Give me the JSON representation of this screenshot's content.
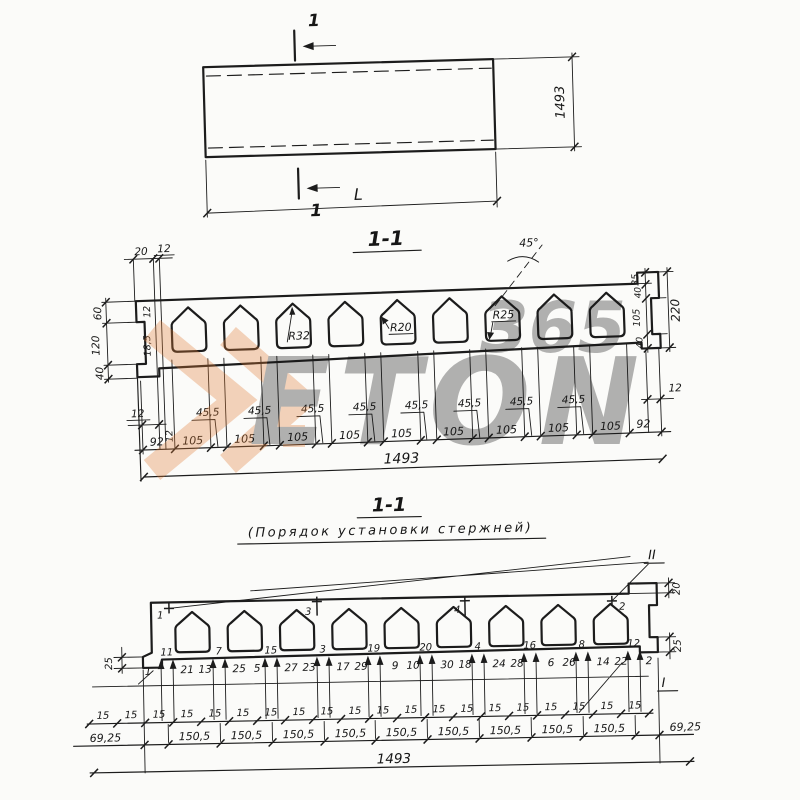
{
  "watermark": {
    "word": "ETON",
    "number": "365",
    "orange": "#e07c35",
    "gray": "#a9a9a9"
  },
  "plan": {
    "cut_label": "1",
    "width": "1493",
    "length": "L"
  },
  "section": {
    "title": "1-1",
    "angle": "45°",
    "radius_labels": [
      "R32",
      "R20",
      "R25"
    ],
    "top_left_dims": [
      "20",
      "12"
    ],
    "left_chain": [
      "60",
      "120",
      "40"
    ],
    "bar_dims": [
      "12",
      "18,5",
      "12"
    ],
    "left_offset": "12",
    "right_offset": "12",
    "edge_left": "92",
    "edge_right": "92",
    "void_dims": [
      "105",
      "105",
      "105",
      "105",
      "105",
      "105",
      "105",
      "105",
      "105"
    ],
    "web_dims": [
      "45,5",
      "45,5",
      "45,5",
      "45,5",
      "45,5",
      "45,5",
      "45,5",
      "45,5"
    ],
    "right_chain": [
      "35",
      "40",
      "105",
      "40"
    ],
    "height": "220",
    "overall": "1493"
  },
  "order": {
    "title": "1-1",
    "subtitle": "(Порядок установки стержней)",
    "roman_top": "II",
    "roman_side": "I",
    "marker_labels": [
      "1",
      "3",
      "4",
      "2"
    ],
    "first_bar": "1",
    "group_labels": [
      "11",
      "7",
      "15",
      "3",
      "19",
      "20",
      "4",
      "16",
      "8",
      "12"
    ],
    "line_labels": [
      "21",
      "13",
      "25",
      "5",
      "27",
      "23",
      "17",
      "29",
      "9",
      "10",
      "30",
      "18",
      "24",
      "28",
      "6",
      "26",
      "14",
      "22",
      "2"
    ],
    "spacing_dims": [
      "15",
      "15",
      "15",
      "15",
      "15",
      "15",
      "15",
      "15",
      "15",
      "15",
      "15",
      "15",
      "15",
      "15",
      "15",
      "15",
      "15",
      "15",
      "15",
      "15"
    ],
    "pitch_dims": [
      "150,5",
      "150,5",
      "150,5",
      "150,5",
      "150,5",
      "150,5",
      "150,5",
      "150,5",
      "150,5"
    ],
    "end_left": "69,25",
    "end_right": "69,25",
    "top_right_dim": "20",
    "right_dim": "25",
    "left_dim": "25",
    "overall": "1493"
  }
}
